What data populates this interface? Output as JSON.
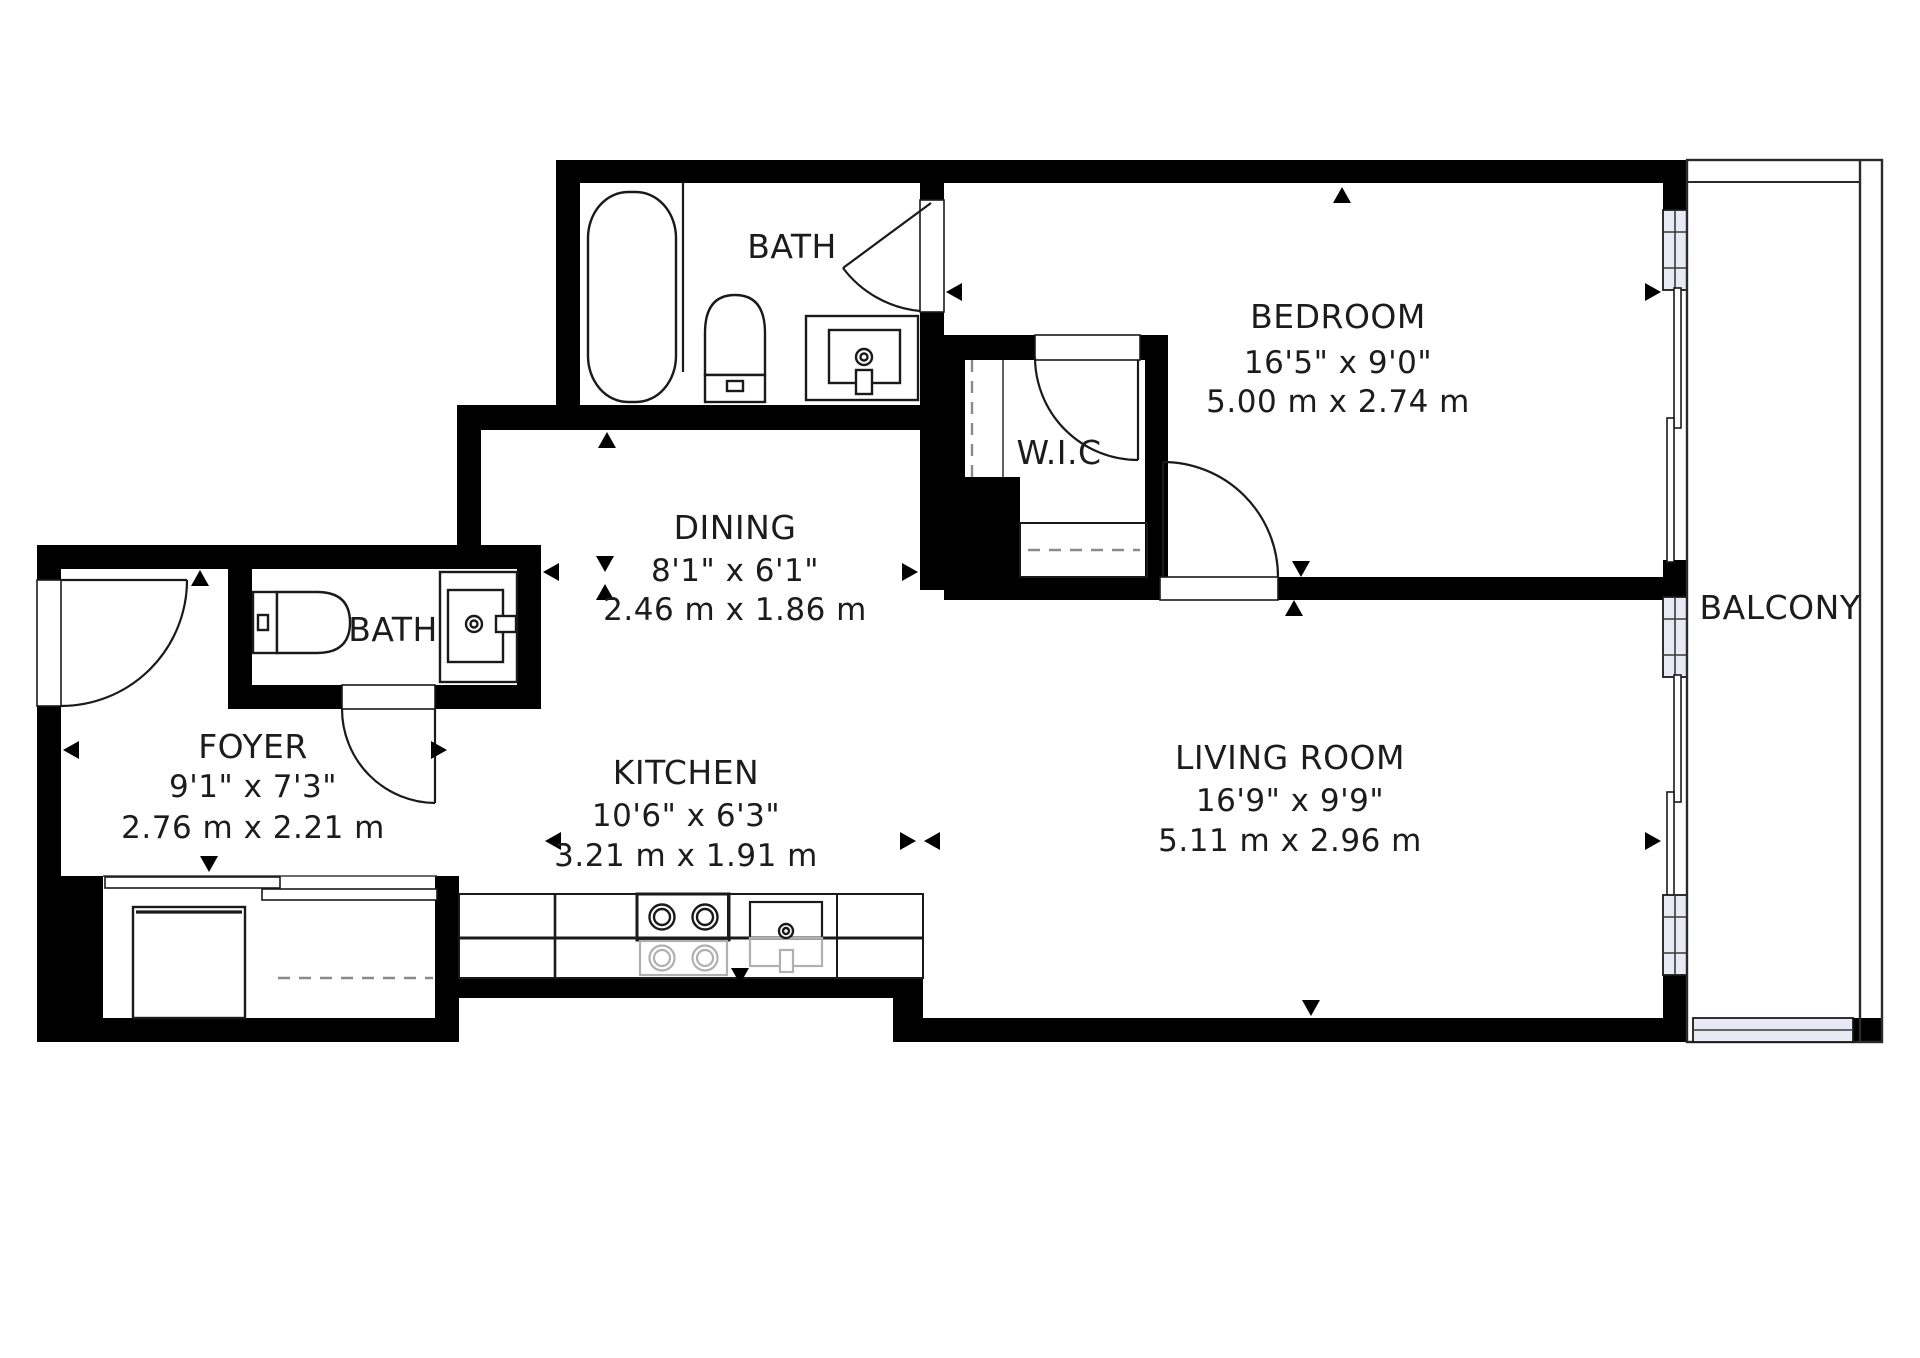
{
  "title": "Apartment floor plan",
  "rooms": {
    "bath_top": {
      "label": "BATH"
    },
    "bedroom": {
      "label": "BEDROOM",
      "size_imperial": "16'5\" x 9'0\"",
      "size_metric": "5.00 m x 2.74 m"
    },
    "wic": {
      "label": "W.I.C"
    },
    "dining": {
      "label": "DINING",
      "size_imperial": "8'1\" x 6'1\"",
      "size_metric": "2.46 m x 1.86 m"
    },
    "bath_foyer": {
      "label": "BATH"
    },
    "foyer": {
      "label": "FOYER",
      "size_imperial": "9'1\" x 7'3\"",
      "size_metric": "2.76 m x 2.21 m"
    },
    "kitchen": {
      "label": "KITCHEN",
      "size_imperial": "10'6\" x 6'3\"",
      "size_metric": "3.21 m x 1.91 m"
    },
    "living_room": {
      "label": "LIVING ROOM",
      "size_imperial": "16'9\" x 9'9\"",
      "size_metric": "5.11 m x 2.96 m"
    },
    "balcony": {
      "label": "BALCONY"
    }
  },
  "colors": {
    "wall": "#000000",
    "line": "#1a1a1a",
    "window_fill": "#e9e9f6",
    "dashed_line": "#8a8a8a",
    "appliance_gray": "#b0b0b0",
    "background": "#ffffff"
  }
}
